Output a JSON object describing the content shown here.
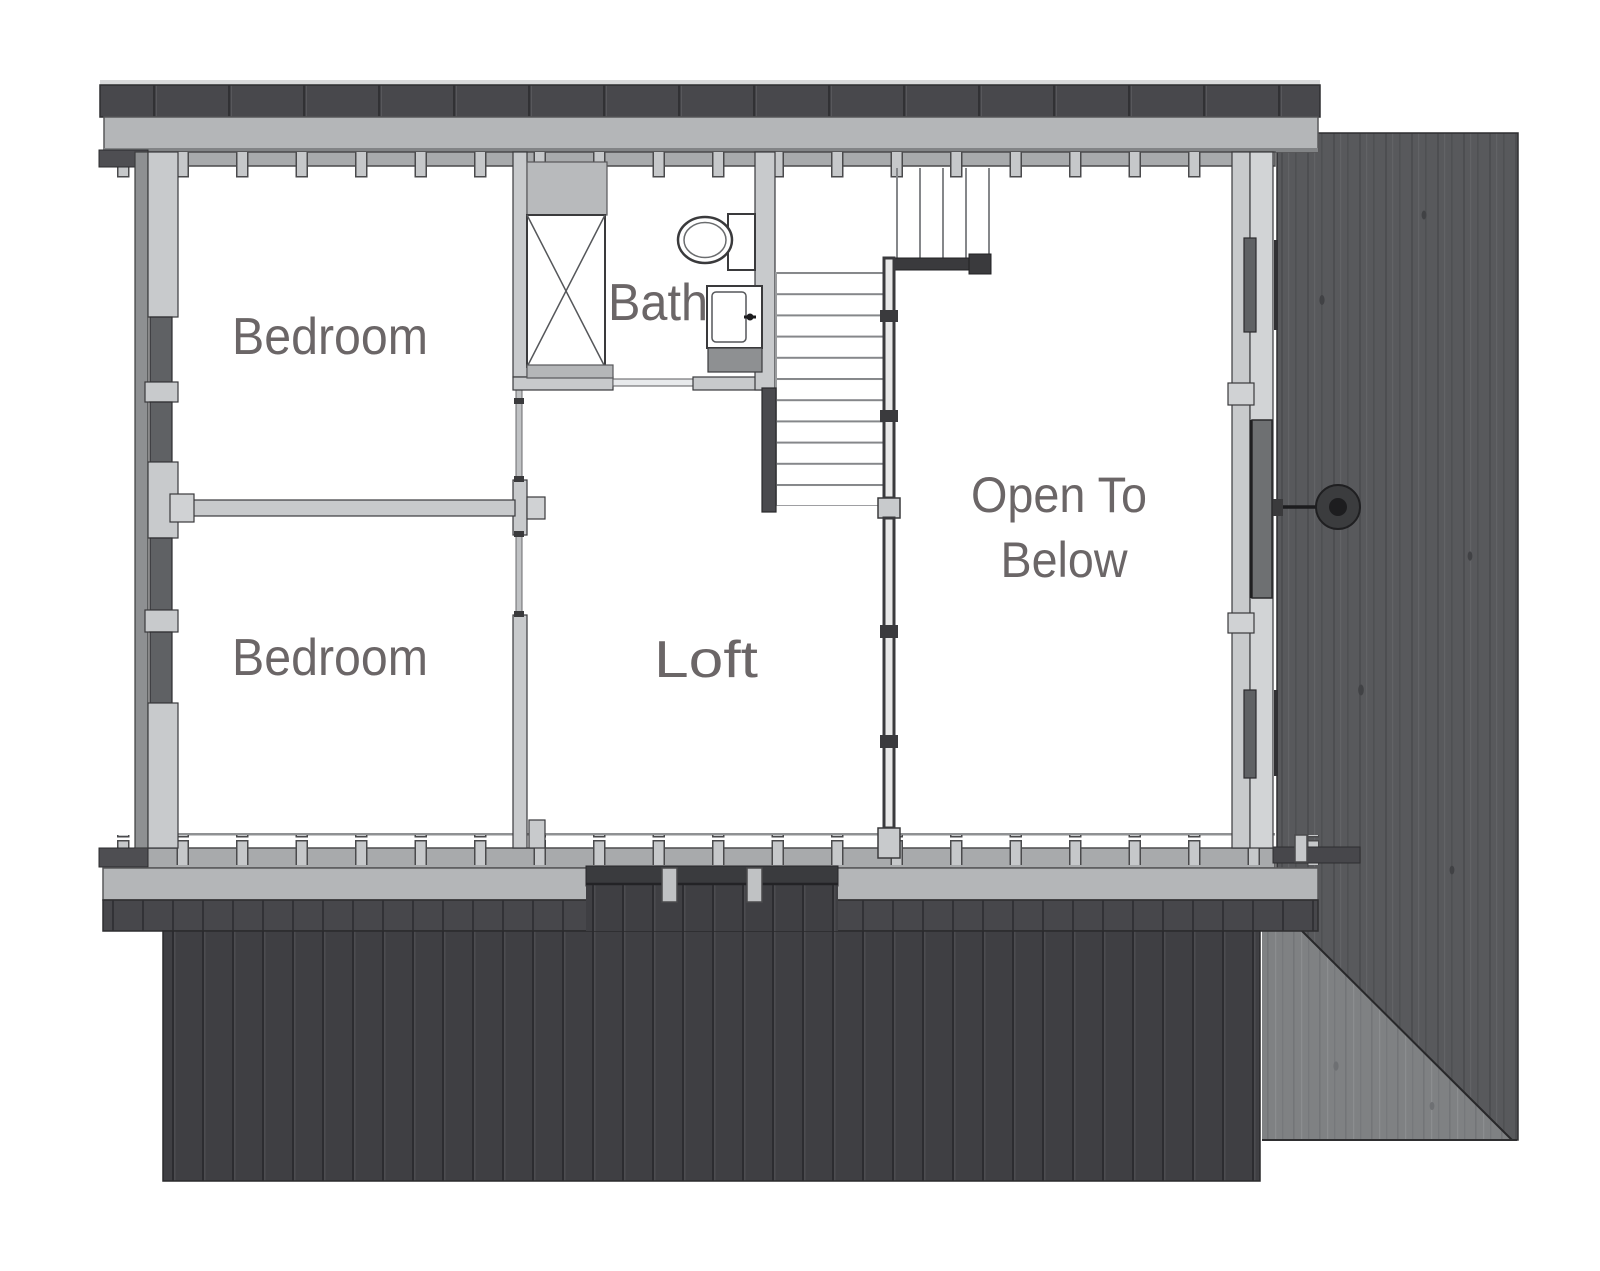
{
  "plan": {
    "labels": {
      "bedroom_top": "Bedroom",
      "bedroom_bottom": "Bedroom",
      "bath": "Bath",
      "loft": "Loft",
      "open_below_line1": "Open To",
      "open_below_line2": "Below"
    },
    "fixtures": {
      "shower": "shower",
      "toilet": "toilet",
      "sink": "sink",
      "stairs": "stairs",
      "railing": "railing",
      "wall_light": "wall-light"
    },
    "colors": {
      "label_text": "#6b6667",
      "roof_dark": "#47474b",
      "siding_dark": "#3f3f43",
      "eave_light": "#b4b6b8",
      "wall_light": "#c8cacc",
      "window_dark": "#5f6164",
      "wood_panel": "#58595c",
      "wood_panel_light": "#7f8183",
      "railing_dark": "#3a3a3d"
    }
  }
}
